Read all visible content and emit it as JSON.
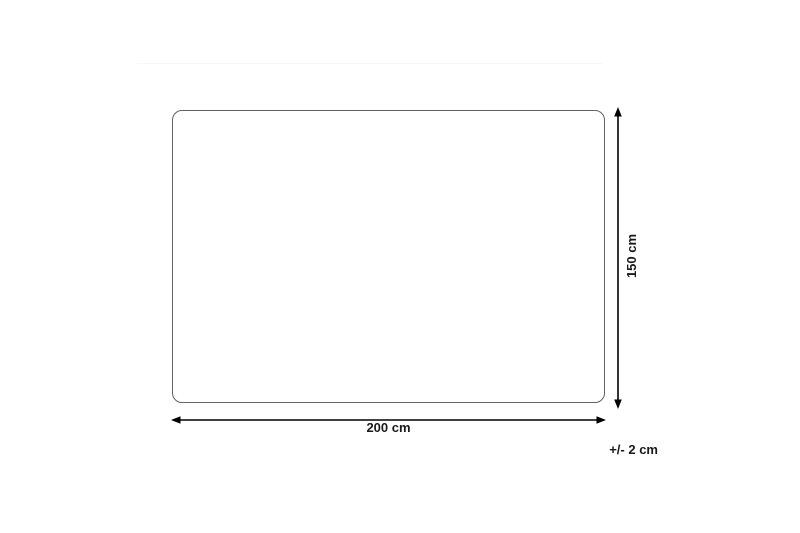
{
  "diagram": {
    "type": "dimension-diagram",
    "shape": "rounded-rectangle",
    "labels": {
      "width": "200 cm",
      "height": "150 cm",
      "tolerance": "+/- 2 cm"
    },
    "values": {
      "width_cm": 200,
      "height_cm": 150,
      "tolerance_cm": 2
    },
    "colors": {
      "background": "#ffffff",
      "outline": "#606265",
      "arrow": "#000000",
      "text": "#1a1a1a"
    }
  }
}
